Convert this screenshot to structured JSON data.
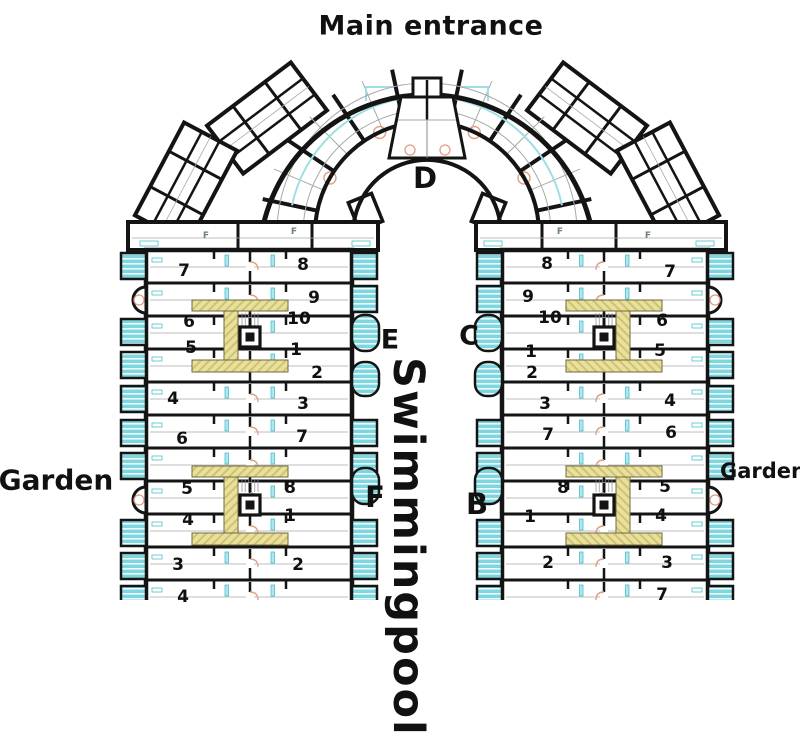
{
  "title": "Main entrance",
  "blocks": {
    "d": "D",
    "e": "E",
    "c": "C",
    "f": "F",
    "b": "B"
  },
  "garden_left": "Garden",
  "garden_right": "Garden",
  "pool": "Swimmingpool",
  "strip_marks": {
    "left1": "F",
    "left2": "F",
    "right1": "F",
    "right2": "F"
  },
  "left_wing_units": [
    {
      "n": "7",
      "x": 184,
      "y": 271
    },
    {
      "n": "8",
      "x": 303,
      "y": 265
    },
    {
      "n": "9",
      "x": 314,
      "y": 298
    },
    {
      "n": "6",
      "x": 189,
      "y": 322
    },
    {
      "n": "10",
      "x": 299,
      "y": 319
    },
    {
      "n": "5",
      "x": 191,
      "y": 348
    },
    {
      "n": "1",
      "x": 296,
      "y": 350
    },
    {
      "n": "2",
      "x": 317,
      "y": 373
    },
    {
      "n": "4",
      "x": 173,
      "y": 399
    },
    {
      "n": "3",
      "x": 303,
      "y": 404
    },
    {
      "n": "6",
      "x": 182,
      "y": 439
    },
    {
      "n": "7",
      "x": 302,
      "y": 437
    },
    {
      "n": "5",
      "x": 187,
      "y": 489
    },
    {
      "n": "8",
      "x": 290,
      "y": 488
    },
    {
      "n": "4",
      "x": 188,
      "y": 520
    },
    {
      "n": "1",
      "x": 290,
      "y": 516
    },
    {
      "n": "3",
      "x": 178,
      "y": 565
    },
    {
      "n": "2",
      "x": 298,
      "y": 565
    },
    {
      "n": "4",
      "x": 183,
      "y": 597
    }
  ],
  "right_wing_units": [
    {
      "n": "8",
      "x": 547,
      "y": 264
    },
    {
      "n": "7",
      "x": 670,
      "y": 272
    },
    {
      "n": "9",
      "x": 528,
      "y": 297
    },
    {
      "n": "10",
      "x": 550,
      "y": 318
    },
    {
      "n": "6",
      "x": 662,
      "y": 321
    },
    {
      "n": "1",
      "x": 531,
      "y": 352
    },
    {
      "n": "5",
      "x": 660,
      "y": 351
    },
    {
      "n": "2",
      "x": 532,
      "y": 373
    },
    {
      "n": "3",
      "x": 545,
      "y": 404
    },
    {
      "n": "4",
      "x": 670,
      "y": 401
    },
    {
      "n": "7",
      "x": 548,
      "y": 435
    },
    {
      "n": "6",
      "x": 671,
      "y": 433
    },
    {
      "n": "8",
      "x": 563,
      "y": 488
    },
    {
      "n": "5",
      "x": 665,
      "y": 487
    },
    {
      "n": "1",
      "x": 530,
      "y": 517
    },
    {
      "n": "4",
      "x": 661,
      "y": 516
    },
    {
      "n": "2",
      "x": 548,
      "y": 563
    },
    {
      "n": "3",
      "x": 667,
      "y": 563
    },
    {
      "n": "7",
      "x": 662,
      "y": 595
    }
  ],
  "colors": {
    "wall": "#141414",
    "balcony_fill": "#7fd6de",
    "balcony_stripe": "#eafcfd",
    "core_fill": "#e9e09c",
    "core_hatch": "#cfc276",
    "door_arc": "#dfa183",
    "fixture_cyan": "#49c0cc",
    "thin_line": "#a8a8a8"
  }
}
